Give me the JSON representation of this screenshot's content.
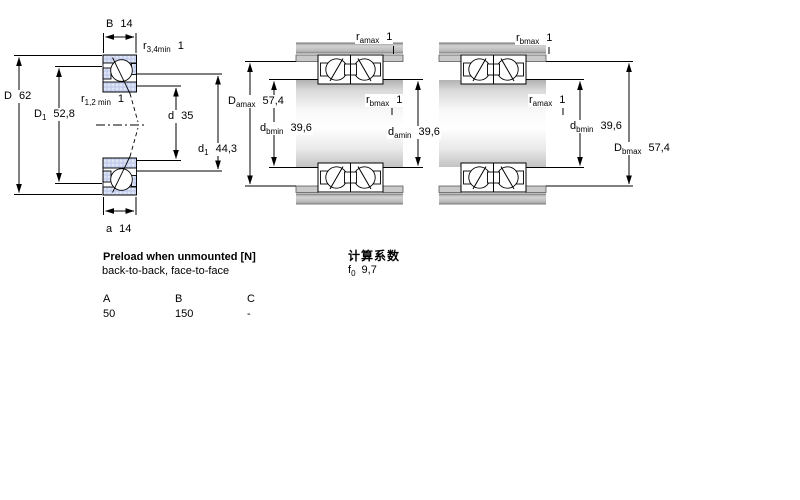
{
  "figures": {
    "left": {
      "labels": {
        "B": {
          "base": "B",
          "sub": "",
          "value": "14"
        },
        "r34": {
          "base": "r",
          "sub": "3,4min",
          "value": "1"
        },
        "D": {
          "base": "D",
          "sub": "",
          "value": "62"
        },
        "D1": {
          "base": "D",
          "sub": "1",
          "value": "52,8"
        },
        "r12": {
          "base": "r",
          "sub": "1,2 min",
          "value": "1"
        },
        "d": {
          "base": "d",
          "sub": "",
          "value": "35"
        },
        "d1": {
          "base": "d",
          "sub": "1",
          "value": "44,3"
        },
        "a": {
          "base": "a",
          "sub": "",
          "value": "14"
        }
      }
    },
    "middle": {
      "labels": {
        "ramax": {
          "base": "r",
          "sub": "amax",
          "value": "1"
        },
        "Damax": {
          "base": "D",
          "sub": "amax",
          "value": "57,4"
        },
        "rbmax": {
          "base": "r",
          "sub": "bmax",
          "value": "1"
        },
        "dbmin": {
          "base": "d",
          "sub": "bmin",
          "value": "39,6"
        },
        "damin": {
          "base": "d",
          "sub": "amin",
          "value": "39,6"
        }
      }
    },
    "right": {
      "labels": {
        "rbmax": {
          "base": "r",
          "sub": "bmax",
          "value": "1"
        },
        "ramax": {
          "base": "r",
          "sub": "amax",
          "value": "1"
        },
        "dbmin": {
          "base": "d",
          "sub": "bmin",
          "value": "39,6"
        },
        "Dbmax": {
          "base": "D",
          "sub": "bmax",
          "value": "57,4"
        }
      }
    }
  },
  "preload": {
    "title": "Preload when unmounted [N]",
    "subtitle": "back-to-back, face-to-face",
    "table": {
      "headers": [
        "A",
        "B",
        "C"
      ],
      "values": [
        "50",
        "150",
        "-"
      ]
    }
  },
  "calculation": {
    "title": "计算系数",
    "f0": {
      "base": "f",
      "sub": "0",
      "value": "9,7"
    }
  },
  "colors": {
    "line": "#000000",
    "bearing_fill": "#cbd5ef",
    "housing_gray": "#c3c3c3"
  }
}
